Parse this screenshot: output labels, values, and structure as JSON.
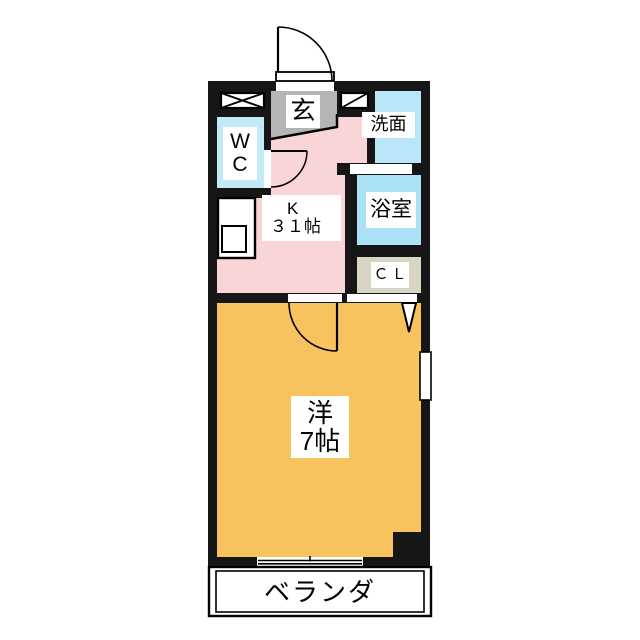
{
  "title": "1K apartment floor plan",
  "colors": {
    "wall": "#161616",
    "line": "#000000",
    "label_bg": "#ffffff",
    "genkan": "#b5b5b5",
    "kitchen": "#f9d5d7",
    "wc": "#c2eaf6",
    "washroom": "#b9e7f8",
    "bath": "#abe1f6",
    "closet": "#d9d5c5",
    "western_room": "#f8c35f",
    "veranda": "#ffffff"
  },
  "rooms": {
    "genkan": {
      "label": "玄"
    },
    "wc": {
      "line1": "W",
      "line2": "C"
    },
    "washroom": {
      "label": "洗面"
    },
    "bath": {
      "label": "浴室"
    },
    "closet": {
      "label": "ＣＬ"
    },
    "kitchen": {
      "line1": "K",
      "line2": "３１帖"
    },
    "western_room": {
      "line1": "洋",
      "line2": "7帖"
    },
    "veranda": {
      "label": "ベランダ"
    }
  },
  "icons": {
    "pipe_space": "x-cross-box-icon",
    "meter_box": "single-diagonal-box-icon",
    "entrance_door": "door-swing-arc-icon",
    "wc_door": "door-swing-arc-icon",
    "room_door": "door-swing-arc-icon",
    "closet_door": "v-fold-door-icon",
    "sliding_window": "double-line-window-icon",
    "kitchen_sink": "counter-with-sink-icon"
  }
}
